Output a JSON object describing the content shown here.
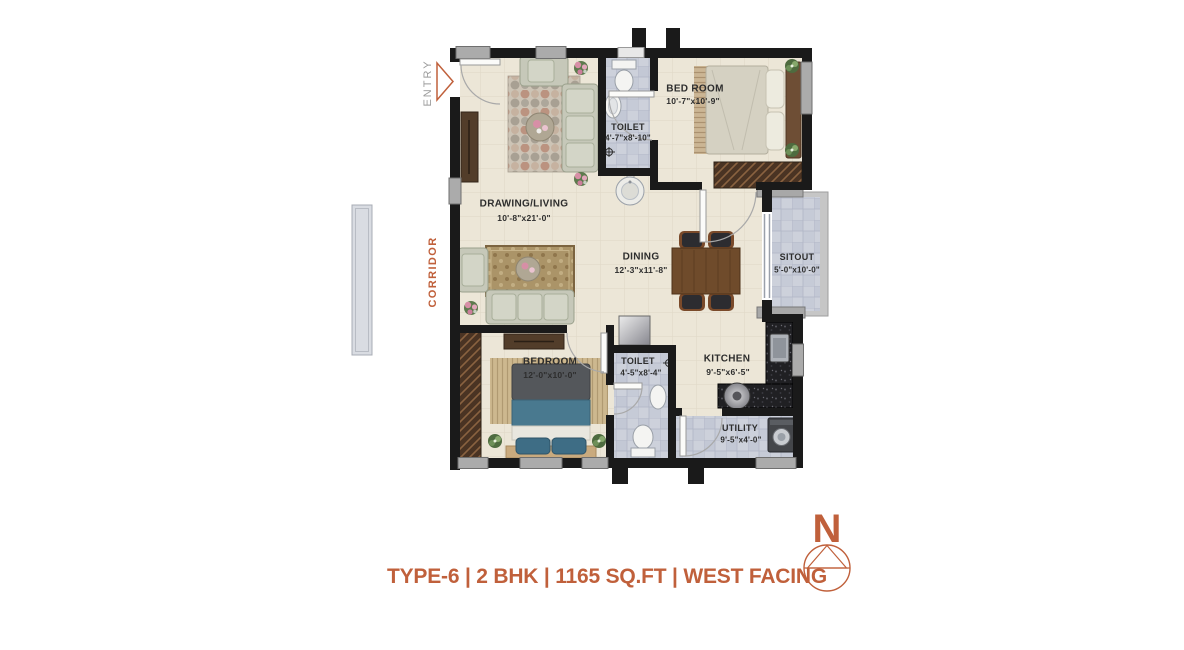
{
  "caption": "TYPE-6 | 2 BHK | 1165 SQ.FT | WEST FACING",
  "compass": {
    "north": "N"
  },
  "annotations": {
    "entry": "ENTRY",
    "corridor": "CORRIDOR"
  },
  "rooms": {
    "drawing_living": {
      "name": "DRAWING/LIVING",
      "dims": "10'-8\"x21'-0\""
    },
    "toilet_top": {
      "name": "TOILET",
      "dims": "4'-7\"x8'-10\""
    },
    "bedroom_top": {
      "name": "BED ROOM",
      "dims": "10'-7\"x10'-9\""
    },
    "dining": {
      "name": "DINING",
      "dims": "12'-3\"x11'-8\""
    },
    "sitout": {
      "name": "SITOUT",
      "dims": "5'-0\"x10'-0\""
    },
    "bedroom_bottom": {
      "name": "BEDROOM",
      "dims": "12'-0\"x10'-0\""
    },
    "toilet_bottom": {
      "name": "TOILET",
      "dims": "4'-5\"x8'-4\""
    },
    "kitchen": {
      "name": "KITCHEN",
      "dims": "9'-5\"x6'-5\""
    },
    "utility": {
      "name": "UTILITY",
      "dims": "9'-5\"x4'-0\""
    }
  },
  "colors": {
    "accent": "#c0603b",
    "wall": "#1a1a1a",
    "floor_cream": "#ece6d7",
    "floor_tile": "#cdd1db",
    "entry_text": "#9b9b9b",
    "label_text": "#2d2d2d"
  }
}
